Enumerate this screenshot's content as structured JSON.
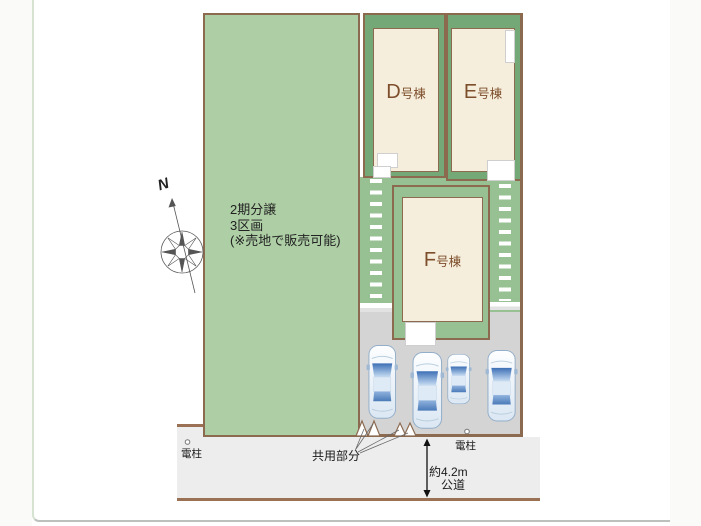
{
  "plan": {
    "north_label": "N",
    "phase_lot": {
      "lines": [
        "2期分譲",
        "3区画",
        "(※売地で販売可能)"
      ]
    },
    "buildings": [
      {
        "id": "d",
        "letter": "D",
        "suffix": "号棟"
      },
      {
        "id": "e",
        "letter": "E",
        "suffix": "号棟"
      },
      {
        "id": "f",
        "letter": "F",
        "suffix": "号棟"
      }
    ],
    "labels": {
      "pole_left": "電柱",
      "pole_right": "電柱",
      "common_area": "共用部分",
      "road_width": "約4.2m",
      "road_kind": "公道"
    },
    "colors": {
      "lot_light_green": "#aecfa5",
      "lot_green": "#74a876",
      "walkway_green": "#97c193",
      "building_cream": "#f6eedc",
      "border_brown": "#8b6a50",
      "parking_gray": "#d4d4d4",
      "road_gray": "#ededed",
      "label_brown": "#7d4e2c",
      "car_blue": "#4a7fc1"
    }
  }
}
